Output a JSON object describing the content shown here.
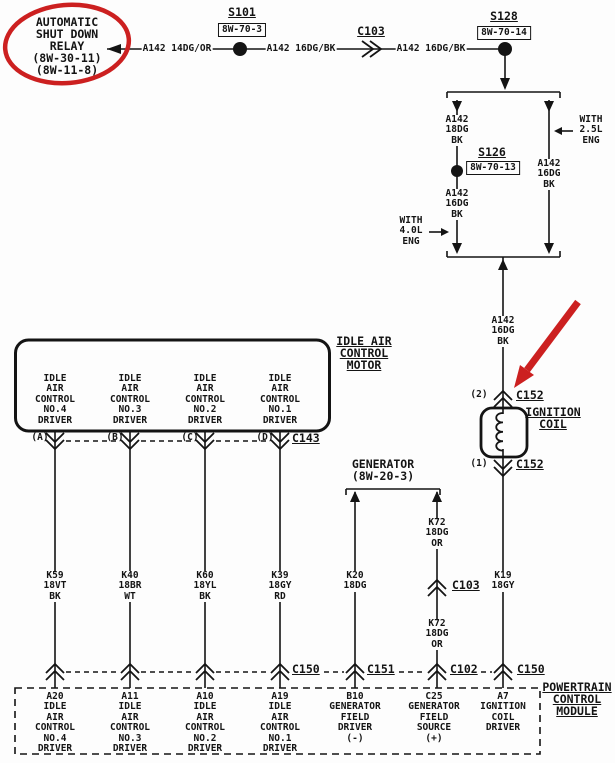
{
  "colors": {
    "ink": "#141414",
    "annotation_red": "#cc2020",
    "paper": "#fdfdfd"
  },
  "relay": {
    "label": "AUTOMATIC\nSHUT DOWN\nRELAY\n(8W-30-11)\n(8W-11-8)"
  },
  "top": {
    "wire_a": "A142 14DG/OR",
    "splice_s101": {
      "name": "S101",
      "ref": "8W-70-3"
    },
    "wire_b": "A142 16DG/BK",
    "connector_c103": "C103",
    "wire_c": "A142 16DG/BK",
    "splice_s128": {
      "name": "S128",
      "ref": "8W-70-14"
    }
  },
  "split": {
    "left_wire_upper": "A142\n18DG\nBK",
    "splice_s126": {
      "name": "S126",
      "ref": "8W-70-13"
    },
    "left_wire_lower": "A142\n16DG\nBK",
    "left_note": "WITH\n4.0L\nENG",
    "right_wire": "A142\n16DG\nBK",
    "right_note": "WITH\n2.5L\nENG",
    "merged_wire": "A142\n16DG\nBK"
  },
  "ignition": {
    "pin_top": "(2)",
    "conn_top": "C152",
    "label": "IGNITION\nCOIL",
    "pin_bottom": "(1)",
    "conn_bottom": "C152",
    "wire": "K19\n18GY",
    "conn_pcm": "C150",
    "pcm_pin": "A7\nIGNITION\nCOIL\nDRIVER"
  },
  "iac": {
    "label": "IDLE AIR\nCONTROL\nMOTOR",
    "connector": "C143",
    "conn_pcm": "C150",
    "channels": [
      {
        "pin": "(A)",
        "driver": "IDLE\nAIR\nCONTROL\nNO.4\nDRIVER",
        "wire": "K59\n18VT\nBK",
        "pcm_pin": "A20\nIDLE\nAIR\nCONTROL\nNO.4\nDRIVER"
      },
      {
        "pin": "(B)",
        "driver": "IDLE\nAIR\nCONTROL\nNO.3\nDRIVER",
        "wire": "K40\n18BR\nWT",
        "pcm_pin": "A11\nIDLE\nAIR\nCONTROL\nNO.3\nDRIVER"
      },
      {
        "pin": "(C)",
        "driver": "IDLE\nAIR\nCONTROL\nNO.2\nDRIVER",
        "wire": "K60\n18YL\nBK",
        "pcm_pin": "A10\nIDLE\nAIR\nCONTROL\nNO.2\nDRIVER"
      },
      {
        "pin": "(D)",
        "driver": "IDLE\nAIR\nCONTROL\nNO.1\nDRIVER",
        "wire": "K39\n18GY\nRD",
        "pcm_pin": "A19\nIDLE\nAIR\nCONTROL\nNO.1\nDRIVER"
      }
    ]
  },
  "generator": {
    "label": "GENERATOR\n(8W-20-3)",
    "field_driver": {
      "wire": "K20\n18DG",
      "conn": "C151",
      "pcm_pin": "B10\nGENERATOR\nFIELD\nDRIVER\n(-)"
    },
    "field_source": {
      "wire_upper": "K72\n18DG\nOR",
      "conn_mid": "C103",
      "wire_lower": "K72\n18DG\nOR",
      "conn": "C102",
      "pcm_pin": "C25\nGENERATOR\nFIELD\nSOURCE\n(+)"
    }
  },
  "pcm": {
    "label": "POWERTRAIN\nCONTROL\nMODULE"
  }
}
